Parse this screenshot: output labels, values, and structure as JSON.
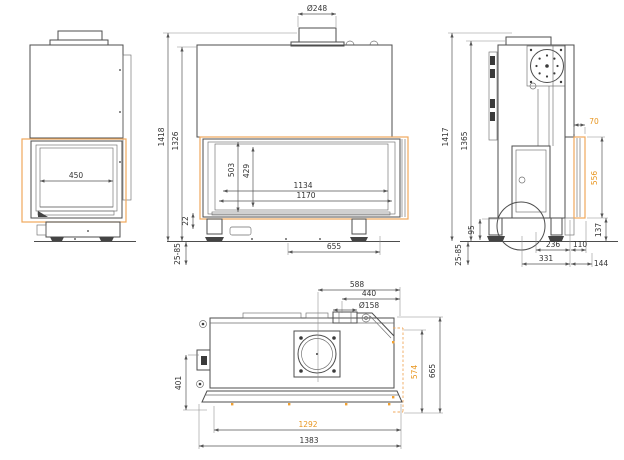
{
  "drawing": {
    "colors": {
      "accent_orange": "#E8951E",
      "highlight_orange": "#F0A85C",
      "line": "#4D4D4D"
    },
    "views": {
      "left": {
        "dims": {
          "glass_width": "450"
        }
      },
      "front": {
        "dims": {
          "flue_diameter": "Ø248",
          "overall_height": "1418",
          "body_height": "1326",
          "opening_height": "503",
          "glass_height": "429",
          "glass_width": "1134",
          "opening_width": "1170",
          "foot_spacing": "655",
          "bottom_trim": "22",
          "foot_adjustment": "25-85"
        }
      },
      "right": {
        "dims": {
          "overall_height": "1417",
          "body_height": "1365",
          "glass_depth": "70",
          "glass_height": "556",
          "plinth_height": "137",
          "duct_height": "95",
          "foot_adjustment": "25-85",
          "duct_to_front": "236",
          "front_overhang": "110",
          "base_to_front": "331",
          "front_section": "144"
        }
      },
      "top": {
        "dims": {
          "flue_from_right": "588",
          "flue_from_edge": "440",
          "flue_diameter": "Ø158",
          "left_depth": "401",
          "side_glass_depth": "574",
          "overall_depth": "665",
          "glass_width": "1292",
          "overall_width": "1383"
        }
      }
    }
  }
}
